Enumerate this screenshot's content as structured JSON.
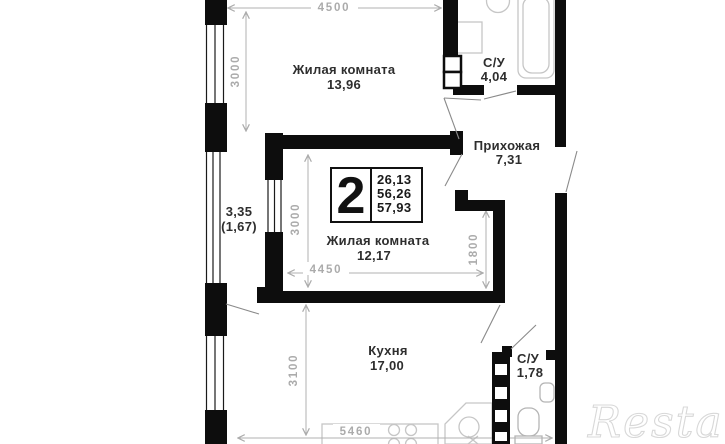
{
  "plan": {
    "rooms": {
      "living1": {
        "name": "Жилая комната",
        "area": "13,96"
      },
      "bath1": {
        "name": "С/У",
        "area": "4,04"
      },
      "hallway": {
        "name": "Прихожая",
        "area": "7,31"
      },
      "balcony": {
        "area": "3,35",
        "area_secondary": "(1,67)"
      },
      "living2": {
        "name": "Жилая комната",
        "area": "12,17"
      },
      "kitchen": {
        "name": "Кухня",
        "area": "17,00"
      },
      "bath2": {
        "name": "С/У",
        "area": "1,78"
      }
    },
    "dims": {
      "top": "4500",
      "left_upper": "3000",
      "left_middle": "3000",
      "width_middle": "4450",
      "depth_right": "1800",
      "left_lower": "3100",
      "bottom": "5460"
    },
    "info_box": {
      "rooms_count": "2",
      "line1": "26,13",
      "line2": "56,26",
      "line3": "57,93"
    },
    "watermark": "Restate",
    "colors": {
      "wall": "#0d0d0d",
      "dimension": "#ababab",
      "label": "#2e2e2e",
      "fixture": "#c6c6c6",
      "watermark": "#d8d8d8"
    }
  }
}
